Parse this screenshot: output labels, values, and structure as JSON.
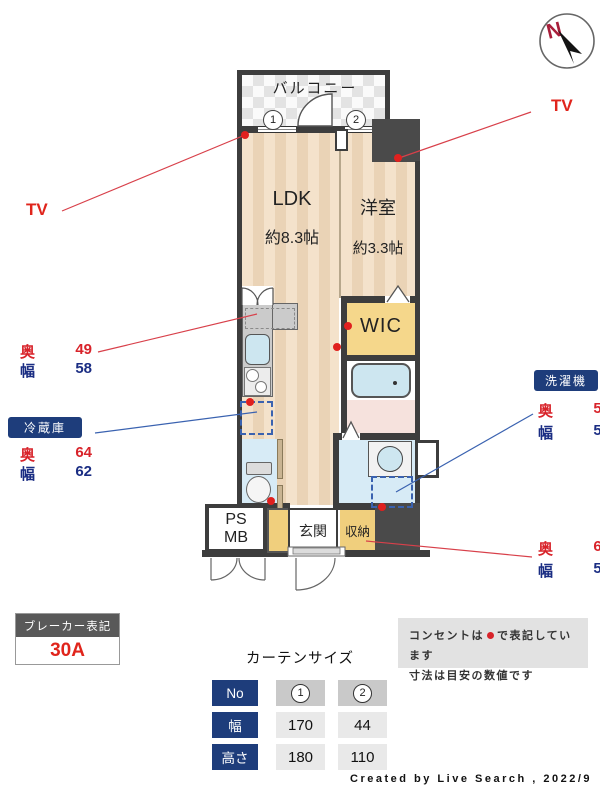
{
  "compass": {
    "north_label": "N"
  },
  "plan": {
    "balcony": "バルコニー",
    "ldk": {
      "name": "LDK",
      "area": "約8.3帖"
    },
    "western_room": {
      "name": "洋室",
      "area": "約3.3帖"
    },
    "wic": "WIC",
    "entrance": "玄関",
    "storage": "収納",
    "ps": "PS",
    "mb": "MB",
    "window1": "1",
    "window2": "2"
  },
  "labels": {
    "tv_left": "TV",
    "tv_right": "TV",
    "depth_label": "奥",
    "width_label": "幅",
    "kitchen_space": {
      "depth": "49",
      "width": "58"
    },
    "fridge": {
      "badge": "冷蔵庫",
      "depth": "64",
      "width": "62"
    },
    "washer": {
      "badge": "洗濯機",
      "depth": "59",
      "width": "59"
    },
    "storage_meas": {
      "depth": "68",
      "width": "50"
    }
  },
  "breaker": {
    "title": "ブレーカー表記",
    "value": "30A"
  },
  "curtain_table": {
    "title": "カーテンサイズ",
    "row_headers": [
      "No",
      "幅",
      "高さ"
    ],
    "col1": {
      "no": "1",
      "width": "170",
      "height": "180"
    },
    "col2": {
      "no": "2",
      "width": "44",
      "height": "110"
    }
  },
  "notes": {
    "line1_pre": "コンセントは",
    "line1_post": "で表記しています",
    "line2": "寸法は目安の数値です"
  },
  "colors": {
    "accent_navy": "#1e3d7b",
    "accent_red": "#d8232a",
    "wall": "#3d3d3d",
    "wic_yellow": "#f5d78b",
    "wet_blue": "#d7ebf6"
  },
  "credit": "Created by Live Search , 2022/9"
}
